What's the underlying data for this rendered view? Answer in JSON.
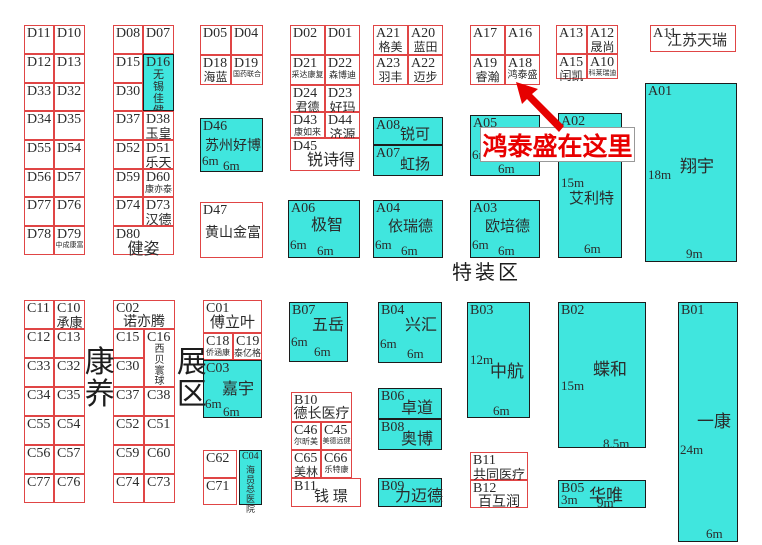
{
  "banner": {
    "text": "鸿泰盛在这里"
  },
  "areas": {
    "special_zone": "特装区",
    "kangyang": "康养",
    "zhanqu": "展区"
  },
  "colors": {
    "booth_fill": "#40e6de",
    "outline_red": "#e04545",
    "outline_dark": "#1c1c1c",
    "banner_red": "#e80000",
    "arrow_red": "#e60000"
  },
  "arrow_points": "516,82 538,89 532,94 564,126 559,132 527,99 522,104",
  "booths": [
    {
      "c": "D11",
      "x": 24,
      "y": 25,
      "w": 30,
      "h": 29
    },
    {
      "c": "D10",
      "x": 54,
      "y": 25,
      "w": 31,
      "h": 29
    },
    {
      "c": "D12",
      "x": 24,
      "y": 54,
      "w": 30,
      "h": 29
    },
    {
      "c": "D13",
      "x": 54,
      "y": 54,
      "w": 31,
      "h": 29
    },
    {
      "c": "D33",
      "x": 24,
      "y": 83,
      "w": 30,
      "h": 28
    },
    {
      "c": "D32",
      "x": 54,
      "y": 83,
      "w": 31,
      "h": 28
    },
    {
      "c": "D34",
      "x": 24,
      "y": 111,
      "w": 30,
      "h": 29
    },
    {
      "c": "D35",
      "x": 54,
      "y": 111,
      "w": 31,
      "h": 29
    },
    {
      "c": "D55",
      "x": 24,
      "y": 140,
      "w": 30,
      "h": 29
    },
    {
      "c": "D54",
      "x": 54,
      "y": 140,
      "w": 31,
      "h": 29
    },
    {
      "c": "D56",
      "x": 24,
      "y": 169,
      "w": 30,
      "h": 28
    },
    {
      "c": "D57",
      "x": 54,
      "y": 169,
      "w": 31,
      "h": 28
    },
    {
      "c": "D77",
      "x": 24,
      "y": 197,
      "w": 30,
      "h": 29
    },
    {
      "c": "D76",
      "x": 54,
      "y": 197,
      "w": 31,
      "h": 29
    },
    {
      "c": "D78",
      "x": 24,
      "y": 226,
      "w": 30,
      "h": 29
    },
    {
      "c": "D79",
      "x": 54,
      "y": 226,
      "w": 31,
      "h": 29,
      "n": "中成康富",
      "nfs": 7
    },
    {
      "c": "D08",
      "x": 113,
      "y": 25,
      "w": 30,
      "h": 29
    },
    {
      "c": "D07",
      "x": 143,
      "y": 25,
      "w": 31,
      "h": 29
    },
    {
      "c": "D15",
      "x": 113,
      "y": 54,
      "w": 30,
      "h": 29
    },
    {
      "c": "D16",
      "x": 143,
      "y": 54,
      "w": 31,
      "h": 57,
      "f": 1,
      "n": "无锡佳健",
      "nfs": 11,
      "nv": 1
    },
    {
      "c": "D30",
      "x": 113,
      "y": 83,
      "w": 30,
      "h": 28
    },
    {
      "c": "D37",
      "x": 113,
      "y": 111,
      "w": 30,
      "h": 29
    },
    {
      "c": "D38",
      "x": 143,
      "y": 111,
      "w": 31,
      "h": 29,
      "n": "玉皇",
      "nfs": 13
    },
    {
      "c": "D52",
      "x": 113,
      "y": 140,
      "w": 30,
      "h": 29
    },
    {
      "c": "D51",
      "x": 143,
      "y": 140,
      "w": 31,
      "h": 29,
      "n": "乐天",
      "nfs": 13
    },
    {
      "c": "D59",
      "x": 113,
      "y": 169,
      "w": 30,
      "h": 28
    },
    {
      "c": "D60",
      "x": 143,
      "y": 169,
      "w": 31,
      "h": 28,
      "n": "康亦泰",
      "nfs": 9
    },
    {
      "c": "D74",
      "x": 113,
      "y": 197,
      "w": 30,
      "h": 29
    },
    {
      "c": "D73",
      "x": 143,
      "y": 197,
      "w": 31,
      "h": 29,
      "n": "汉德",
      "nfs": 13
    },
    {
      "c": "D80",
      "x": 113,
      "y": 226,
      "w": 61,
      "h": 29,
      "n": "健姿",
      "nfs": 16
    },
    {
      "c": "D05",
      "x": 200,
      "y": 25,
      "w": 31,
      "h": 30
    },
    {
      "c": "D04",
      "x": 231,
      "y": 25,
      "w": 32,
      "h": 30
    },
    {
      "c": "D18",
      "x": 200,
      "y": 55,
      "w": 31,
      "h": 30,
      "n": "海蓝",
      "nfs": 12
    },
    {
      "c": "D19",
      "x": 231,
      "y": 55,
      "w": 32,
      "h": 30,
      "n": "国药联合",
      "nfs": 7
    },
    {
      "c": "D46",
      "x": 200,
      "y": 118,
      "w": 63,
      "h": 54,
      "f": 1,
      "n": "苏州好博",
      "nfs": 14,
      "nx": 4,
      "ny": 21,
      "d": [
        {
          "t": "6m",
          "x": 1,
          "y": 35
        },
        {
          "t": "6m",
          "x": 22,
          "y": 40
        }
      ]
    },
    {
      "c": "D47",
      "x": 200,
      "y": 202,
      "w": 63,
      "h": 56,
      "n": "黄山金富",
      "nfs": 14,
      "nx": 4,
      "ny": 24
    },
    {
      "c": "D02",
      "x": 290,
      "y": 25,
      "w": 35,
      "h": 30
    },
    {
      "c": "D01",
      "x": 325,
      "y": 25,
      "w": 35,
      "h": 30
    },
    {
      "c": "D21",
      "x": 290,
      "y": 55,
      "w": 35,
      "h": 30,
      "n": "采达康复",
      "nfs": 8
    },
    {
      "c": "D22",
      "x": 325,
      "y": 55,
      "w": 35,
      "h": 30,
      "n": "森博迪",
      "nfs": 9
    },
    {
      "c": "D24",
      "x": 290,
      "y": 85,
      "w": 35,
      "h": 27,
      "n": "君德",
      "nfs": 12
    },
    {
      "c": "D23",
      "x": 325,
      "y": 85,
      "w": 35,
      "h": 27,
      "n": "好玛",
      "nfs": 13
    },
    {
      "c": "D43",
      "x": 290,
      "y": 112,
      "w": 35,
      "h": 26,
      "n": "康如来",
      "nfs": 9
    },
    {
      "c": "D44",
      "x": 325,
      "y": 112,
      "w": 35,
      "h": 26,
      "n": "济源",
      "nfs": 13
    },
    {
      "c": "D45",
      "x": 290,
      "y": 138,
      "w": 70,
      "h": 33,
      "n": "锐诗得",
      "nfs": 16,
      "nx": 16,
      "ny": 14
    },
    {
      "c": "A06",
      "x": 288,
      "y": 200,
      "w": 72,
      "h": 58,
      "f": 1,
      "n": "极智",
      "nfs": 16,
      "nx": 22,
      "ny": 17,
      "d": [
        {
          "t": "6m",
          "x": 1,
          "y": 37
        },
        {
          "t": "6m",
          "x": 28,
          "y": 43
        }
      ]
    },
    {
      "c": "A21",
      "x": 373,
      "y": 25,
      "w": 35,
      "h": 30,
      "n": "格美",
      "nfs": 12
    },
    {
      "c": "A20",
      "x": 408,
      "y": 25,
      "w": 35,
      "h": 30,
      "n": "蓝田",
      "nfs": 12
    },
    {
      "c": "A23",
      "x": 373,
      "y": 55,
      "w": 35,
      "h": 30,
      "n": "羽丰",
      "nfs": 12
    },
    {
      "c": "A22",
      "x": 408,
      "y": 55,
      "w": 35,
      "h": 30,
      "n": "迈步",
      "nfs": 12
    },
    {
      "c": "A08",
      "x": 373,
      "y": 117,
      "w": 70,
      "h": 28,
      "f": 1,
      "n": "锐可",
      "nfs": 15,
      "nx": 26,
      "ny": 10
    },
    {
      "c": "A07",
      "x": 373,
      "y": 145,
      "w": 70,
      "h": 31,
      "f": 1,
      "n": "虹扬",
      "nfs": 15,
      "nx": 26,
      "ny": 12
    },
    {
      "c": "A04",
      "x": 373,
      "y": 200,
      "w": 70,
      "h": 58,
      "f": 1,
      "n": "依瑞德",
      "nfs": 15,
      "nx": 14,
      "ny": 19,
      "d": [
        {
          "t": "6m",
          "x": 1,
          "y": 37
        },
        {
          "t": "6m",
          "x": 27,
          "y": 43
        }
      ]
    },
    {
      "c": "A17",
      "x": 470,
      "y": 25,
      "w": 35,
      "h": 30
    },
    {
      "c": "A16",
      "x": 505,
      "y": 25,
      "w": 35,
      "h": 30
    },
    {
      "c": "A19",
      "x": 470,
      "y": 55,
      "w": 35,
      "h": 30,
      "n": "睿瀚",
      "nfs": 12
    },
    {
      "c": "A18",
      "x": 505,
      "y": 55,
      "w": 35,
      "h": 30,
      "n": "鸿泰盛",
      "nfs": 10
    },
    {
      "c": "A05",
      "x": 470,
      "y": 115,
      "w": 70,
      "h": 61,
      "f": 1,
      "d": [
        {
          "t": "6m",
          "x": 1,
          "y": 32
        },
        {
          "t": "6m",
          "x": 27,
          "y": 46
        }
      ]
    },
    {
      "c": "A03",
      "x": 470,
      "y": 200,
      "w": 70,
      "h": 58,
      "f": 1,
      "n": "欧培德",
      "nfs": 15,
      "nx": 14,
      "ny": 19,
      "d": [
        {
          "t": "6m",
          "x": 1,
          "y": 37
        },
        {
          "t": "6m",
          "x": 27,
          "y": 43
        }
      ]
    },
    {
      "c": "A13",
      "x": 556,
      "y": 25,
      "w": 31,
      "h": 29
    },
    {
      "c": "A12",
      "x": 587,
      "y": 25,
      "w": 31,
      "h": 29,
      "n": "晟尚",
      "nfs": 12
    },
    {
      "c": "A15",
      "x": 556,
      "y": 54,
      "w": 31,
      "h": 25,
      "n": "闰凯",
      "nfs": 12
    },
    {
      "c": "A10",
      "x": 587,
      "y": 54,
      "w": 31,
      "h": 25,
      "n": "科莱瑞迪",
      "nfs": 7
    },
    {
      "c": "A02",
      "x": 558,
      "y": 113,
      "w": 64,
      "h": 145,
      "f": 1,
      "n": "艾利特",
      "nfs": 15,
      "nx": 10,
      "ny": 78,
      "d": [
        {
          "t": "15m",
          "x": 2,
          "y": 62
        },
        {
          "t": "6m",
          "x": 25,
          "y": 128
        }
      ]
    },
    {
      "c": "A11",
      "x": 650,
      "y": 25,
      "w": 86,
      "h": 27,
      "n": "江苏天瑞",
      "nfs": 15,
      "nx": 16,
      "ny": 8
    },
    {
      "c": "A01",
      "x": 645,
      "y": 83,
      "w": 92,
      "h": 179,
      "f": 1,
      "n": "翔宇",
      "nfs": 17,
      "nx": 34,
      "ny": 74,
      "d": [
        {
          "t": "18m",
          "x": 2,
          "y": 84
        },
        {
          "t": "9m",
          "x": 40,
          "y": 163
        }
      ]
    },
    {
      "c": "C11",
      "x": 24,
      "y": 300,
      "w": 30,
      "h": 29
    },
    {
      "c": "C10",
      "x": 54,
      "y": 300,
      "w": 31,
      "h": 29,
      "n": "承康",
      "nfs": 13
    },
    {
      "c": "C12",
      "x": 24,
      "y": 329,
      "w": 30,
      "h": 29
    },
    {
      "c": "C13",
      "x": 54,
      "y": 329,
      "w": 31,
      "h": 29
    },
    {
      "c": "C33",
      "x": 24,
      "y": 358,
      "w": 30,
      "h": 29
    },
    {
      "c": "C32",
      "x": 54,
      "y": 358,
      "w": 31,
      "h": 29
    },
    {
      "c": "C34",
      "x": 24,
      "y": 387,
      "w": 30,
      "h": 29
    },
    {
      "c": "C35",
      "x": 54,
      "y": 387,
      "w": 31,
      "h": 29
    },
    {
      "c": "C55",
      "x": 24,
      "y": 416,
      "w": 30,
      "h": 29
    },
    {
      "c": "C54",
      "x": 54,
      "y": 416,
      "w": 31,
      "h": 29
    },
    {
      "c": "C56",
      "x": 24,
      "y": 445,
      "w": 30,
      "h": 29
    },
    {
      "c": "C57",
      "x": 54,
      "y": 445,
      "w": 31,
      "h": 29
    },
    {
      "c": "C77",
      "x": 24,
      "y": 474,
      "w": 30,
      "h": 29
    },
    {
      "c": "C76",
      "x": 54,
      "y": 474,
      "w": 31,
      "h": 29
    },
    {
      "c": "C02",
      "x": 113,
      "y": 300,
      "w": 62,
      "h": 29,
      "n": "诺亦腾",
      "nfs": 14
    },
    {
      "c": "C15",
      "x": 113,
      "y": 329,
      "w": 31,
      "h": 29
    },
    {
      "c": "C16",
      "x": 144,
      "y": 329,
      "w": 31,
      "h": 58,
      "n": "西贝寰球",
      "nfs": 10,
      "nv": 1
    },
    {
      "c": "C30",
      "x": 113,
      "y": 358,
      "w": 31,
      "h": 29
    },
    {
      "c": "C37",
      "x": 113,
      "y": 387,
      "w": 31,
      "h": 29
    },
    {
      "c": "C38",
      "x": 144,
      "y": 387,
      "w": 31,
      "h": 29
    },
    {
      "c": "C52",
      "x": 113,
      "y": 416,
      "w": 31,
      "h": 29
    },
    {
      "c": "C51",
      "x": 144,
      "y": 416,
      "w": 31,
      "h": 29
    },
    {
      "c": "C59",
      "x": 113,
      "y": 445,
      "w": 31,
      "h": 29
    },
    {
      "c": "C60",
      "x": 144,
      "y": 445,
      "w": 31,
      "h": 29
    },
    {
      "c": "C74",
      "x": 113,
      "y": 474,
      "w": 31,
      "h": 29
    },
    {
      "c": "C73",
      "x": 144,
      "y": 474,
      "w": 31,
      "h": 29
    },
    {
      "c": "C01",
      "x": 203,
      "y": 300,
      "w": 59,
      "h": 33,
      "n": "傅立叶",
      "nfs": 15
    },
    {
      "c": "C18",
      "x": 203,
      "y": 333,
      "w": 30,
      "h": 27,
      "n": "侨涵康",
      "nfs": 8
    },
    {
      "c": "C19",
      "x": 233,
      "y": 333,
      "w": 29,
      "h": 27,
      "n": "泰亿格",
      "nfs": 9
    },
    {
      "c": "C03",
      "x": 203,
      "y": 360,
      "w": 59,
      "h": 58,
      "f": 1,
      "n": "嘉宇",
      "nfs": 16,
      "nx": 18,
      "ny": 21,
      "d": [
        {
          "t": "6m",
          "x": 1,
          "y": 36
        },
        {
          "t": "6m",
          "x": 19,
          "y": 44
        }
      ]
    },
    {
      "c": "C62",
      "x": 203,
      "y": 450,
      "w": 34,
      "h": 28
    },
    {
      "c": "C71",
      "x": 203,
      "y": 478,
      "w": 34,
      "h": 27
    },
    {
      "c": "C04",
      "x": 239,
      "y": 450,
      "w": 23,
      "h": 55,
      "f": 1,
      "cfs": 10,
      "n": "海员总医院",
      "nfs": 9,
      "nv": 1
    },
    {
      "c": "B07",
      "x": 289,
      "y": 302,
      "w": 59,
      "h": 60,
      "f": 1,
      "n": "五岳",
      "nfs": 16,
      "nx": 22,
      "ny": 15,
      "d": [
        {
          "t": "6m",
          "x": 1,
          "y": 32
        },
        {
          "t": "6m",
          "x": 24,
          "y": 42
        }
      ]
    },
    {
      "c": "B10",
      "x": 291,
      "y": 392,
      "w": 61,
      "h": 30,
      "n": "德长医疗",
      "nfs": 14
    },
    {
      "c": "C46",
      "x": 291,
      "y": 422,
      "w": 30,
      "h": 28,
      "n": "尔昕美",
      "nfs": 8
    },
    {
      "c": "C45",
      "x": 321,
      "y": 422,
      "w": 31,
      "h": 28,
      "n": "美德远健",
      "nfs": 7
    },
    {
      "c": "C65",
      "x": 291,
      "y": 450,
      "w": 30,
      "h": 28,
      "n": "美林",
      "nfs": 12
    },
    {
      "c": "C66",
      "x": 321,
      "y": 450,
      "w": 31,
      "h": 28,
      "n": "乐特康",
      "nfs": 8
    },
    {
      "c": "B11",
      "x": 291,
      "y": 478,
      "w": 70,
      "h": 29,
      "n": "钱 璟",
      "nfs": 15,
      "nx": 22,
      "ny": 11
    },
    {
      "c": "B04",
      "x": 378,
      "y": 302,
      "w": 64,
      "h": 61,
      "f": 1,
      "n": "兴汇",
      "nfs": 16,
      "nx": 26,
      "ny": 15,
      "d": [
        {
          "t": "6m",
          "x": 1,
          "y": 34
        },
        {
          "t": "6m",
          "x": 28,
          "y": 44
        }
      ]
    },
    {
      "c": "B06",
      "x": 378,
      "y": 388,
      "w": 64,
      "h": 31,
      "f": 1,
      "n": "卓道",
      "nfs": 16,
      "nx": 22,
      "ny": 12
    },
    {
      "c": "B08",
      "x": 378,
      "y": 419,
      "w": 64,
      "h": 31,
      "f": 1,
      "n": "奥博",
      "nfs": 16,
      "nx": 22,
      "ny": 12
    },
    {
      "c": "B09",
      "x": 378,
      "y": 478,
      "w": 64,
      "h": 29,
      "f": 1,
      "n": "力迈德",
      "nfs": 16,
      "nx": 16,
      "ny": 10
    },
    {
      "c": "B03",
      "x": 467,
      "y": 302,
      "w": 63,
      "h": 116,
      "f": 1,
      "n": "中航",
      "nfs": 17,
      "nx": 22,
      "ny": 60,
      "d": [
        {
          "t": "12m",
          "x": 2,
          "y": 50
        },
        {
          "t": "6m",
          "x": 25,
          "y": 101
        }
      ]
    },
    {
      "c": "B11",
      "x": 470,
      "y": 452,
      "w": 58,
      "h": 28,
      "n": "共同医疗",
      "nfs": 13
    },
    {
      "c": "B12",
      "x": 470,
      "y": 480,
      "w": 58,
      "h": 28,
      "n": "百互润",
      "nfs": 14
    },
    {
      "c": "B02",
      "x": 558,
      "y": 302,
      "w": 88,
      "h": 146,
      "f": 1,
      "n": "蝶和",
      "nfs": 17,
      "nx": 34,
      "ny": 58,
      "d": [
        {
          "t": "15m",
          "x": 2,
          "y": 76
        },
        {
          "t": "8.5m",
          "x": 44,
          "y": 134
        }
      ]
    },
    {
      "c": "B05",
      "x": 558,
      "y": 480,
      "w": 88,
      "h": 28,
      "f": 1,
      "n": "华唯",
      "nfs": 17,
      "nx": 30,
      "ny": 6,
      "d": [
        {
          "t": "3m",
          "x": 2,
          "y": 12
        },
        {
          "t": "9m",
          "x": 38,
          "y": 15
        }
      ]
    },
    {
      "c": "B01",
      "x": 678,
      "y": 302,
      "w": 60,
      "h": 240,
      "f": 1,
      "n": "一康",
      "nfs": 17,
      "nx": 18,
      "ny": 110,
      "d": [
        {
          "t": "24m",
          "x": 1,
          "y": 140
        },
        {
          "t": "6m",
          "x": 27,
          "y": 224
        }
      ]
    }
  ]
}
